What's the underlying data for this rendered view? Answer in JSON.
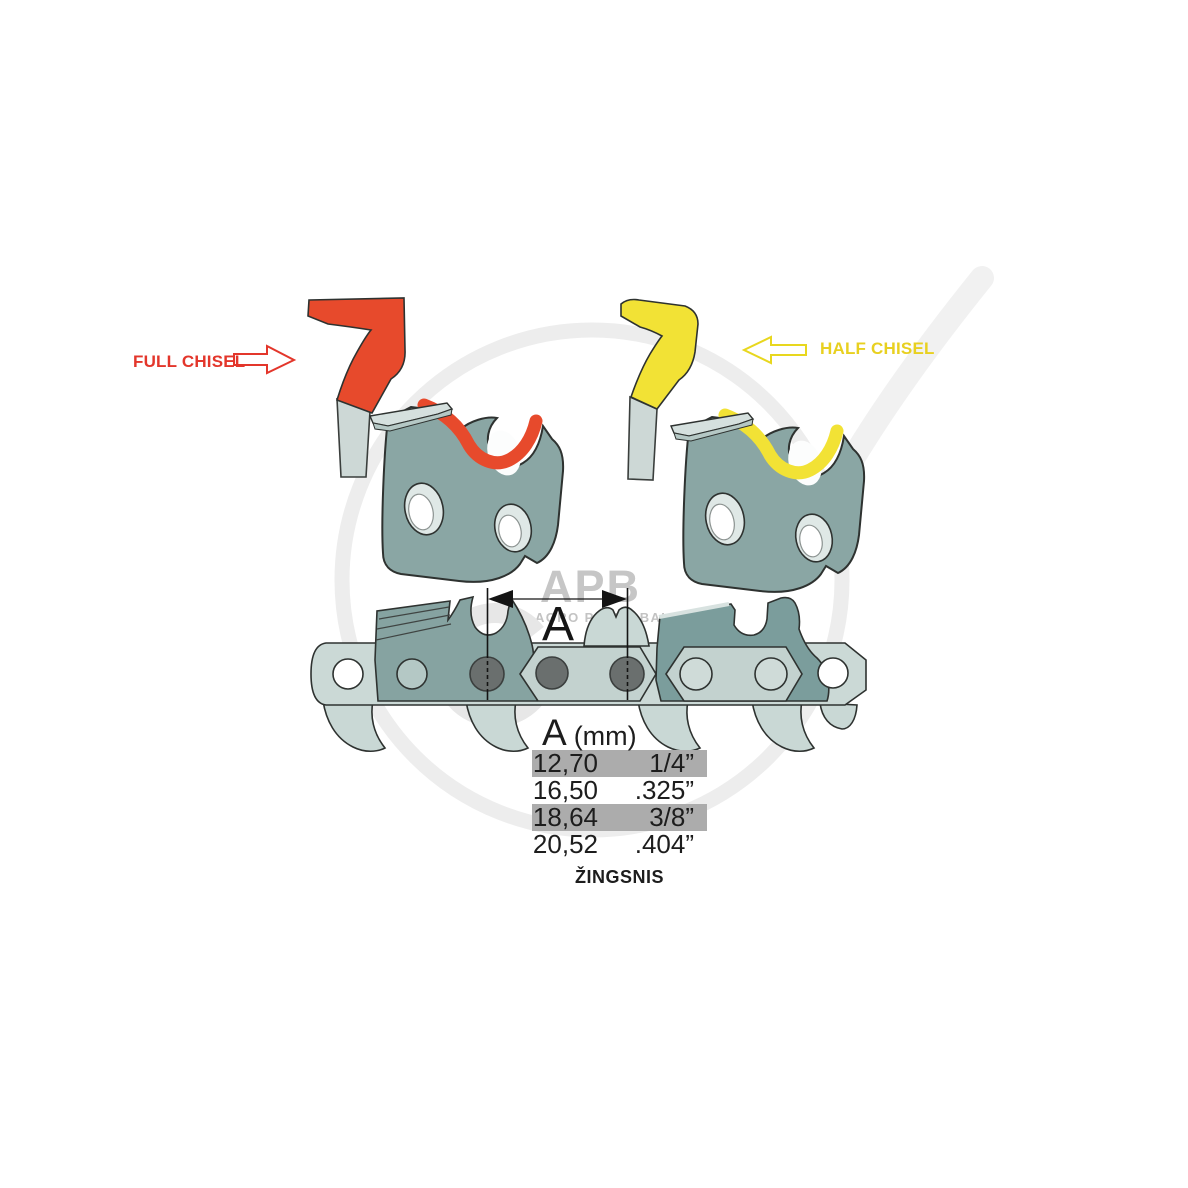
{
  "labels": {
    "full_chisel": "FULL CHISEL",
    "half_chisel": "HALF CHISEL"
  },
  "dimension": {
    "label": "A"
  },
  "watermark": {
    "logo": "APB",
    "subtitle": "AGRO PARTS BALTIJA"
  },
  "pitch_table": {
    "header": {
      "symbol": "A",
      "unit": "(mm)"
    },
    "rows": [
      {
        "mm": "12,70",
        "inch": "1/4”",
        "highlighted": true
      },
      {
        "mm": "16,50",
        "inch": ".325”",
        "highlighted": false
      },
      {
        "mm": "18,64",
        "inch": "3/8”",
        "highlighted": true
      },
      {
        "mm": "20,52",
        "inch": ".404”",
        "highlighted": false
      }
    ],
    "caption": "ŽINGSNIS"
  },
  "colors": {
    "full_chisel_red": "#e74a2c",
    "half_chisel_yellow": "#f2e235",
    "cutter_teal": "#8aa6a4",
    "strap_light": "#cbd9d6",
    "rivet_gray": "#6a6f6e",
    "row_highlight": "#acacac",
    "watermark_gray": "#c6c6c6"
  }
}
